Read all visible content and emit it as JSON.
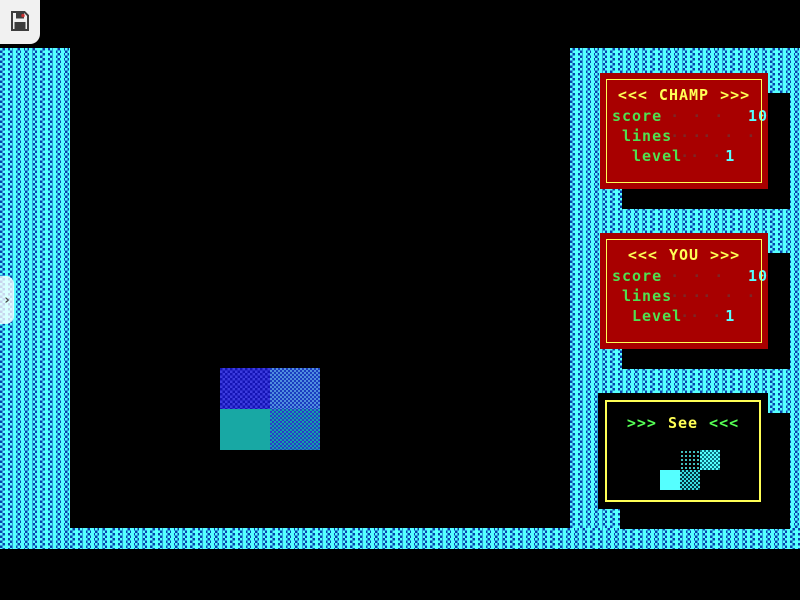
{
  "overlay": {
    "save_button": {
      "icon": "floppy-disk"
    },
    "side_toggle": {
      "icon": "chevron-right",
      "glyph": "›"
    }
  },
  "panels": {
    "champ": {
      "title_prefix": "<<<",
      "title": "CHAMP",
      "title_suffix": ">>>",
      "rows": [
        {
          "label": "score",
          "dots": "· · · · ·",
          "value": "10"
        },
        {
          "label": "lines",
          "dots": "· · · · ·",
          "value": ""
        },
        {
          "label": "level",
          "dots": "· ·",
          "value": "1"
        }
      ]
    },
    "you": {
      "title_prefix": "<<<",
      "title": "YOU",
      "title_suffix": ">>>",
      "rows": [
        {
          "label": "score",
          "dots": "· · · · ·",
          "value": "10"
        },
        {
          "label": "lines",
          "dots": "· · · · ·",
          "value": ""
        },
        {
          "label": "Level",
          "dots": "· ·",
          "value": "1"
        }
      ]
    },
    "see": {
      "title_prefix": ">>>",
      "title": "See",
      "title_suffix": "<<<",
      "next_piece": "S-piece"
    }
  },
  "playfield": {
    "current_piece": "2x2 block (blue top row, teal bottom row)"
  },
  "colors": {
    "border_cyan": "#55FFFF",
    "border_dither_blue": "#0A3FAE",
    "panel_red": "#A80000",
    "panel_border_yellow": "#FFFF55",
    "title_yellow": "#FFFF55",
    "label_green": "#50E050",
    "value_cyan": "#55FFFF",
    "dots_dark_red": "#7D2626",
    "block_blue_dark": "#1414B4",
    "block_blue_light": "#1B3DC0",
    "block_teal": "#18A8A4",
    "preview_cyan": "#55FFFF"
  }
}
